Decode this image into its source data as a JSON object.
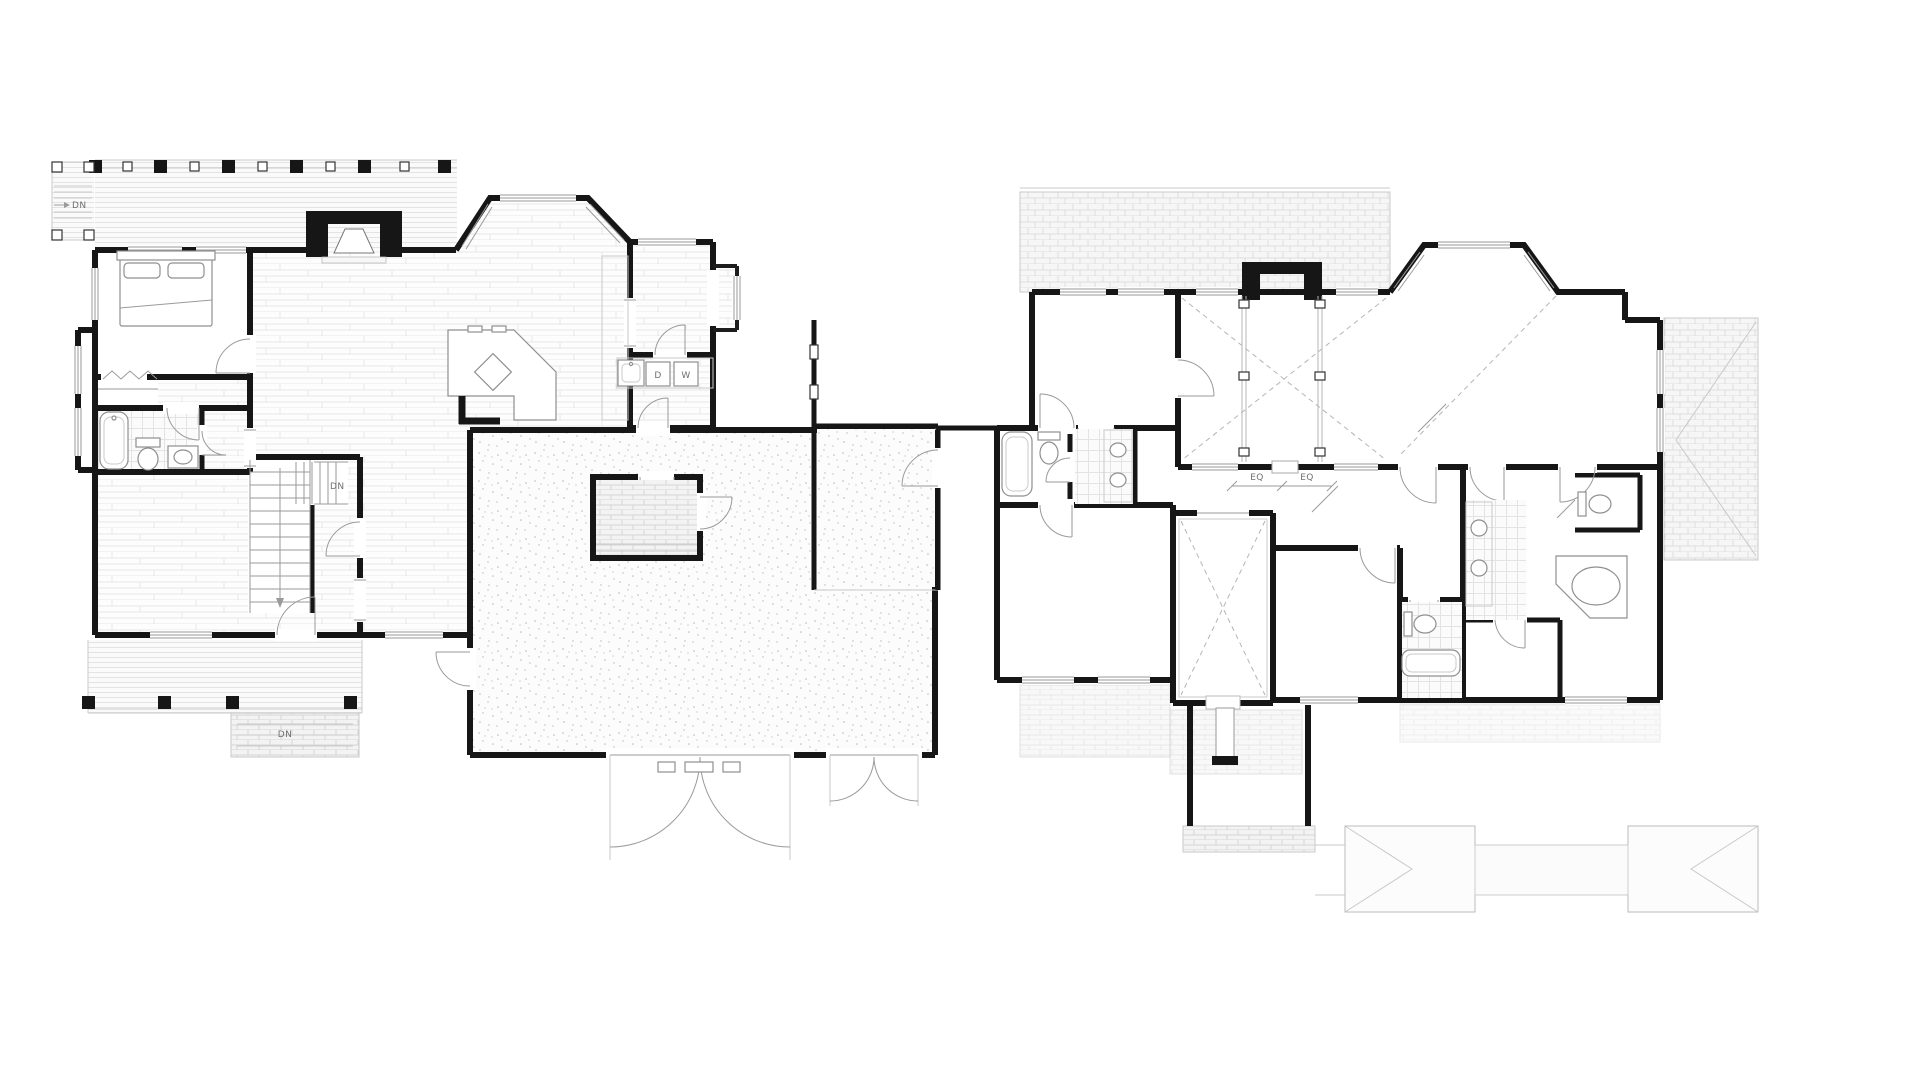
{
  "drawing": {
    "first_floor": {
      "labels": {
        "side_porch_down": "DN",
        "stairs_down": "DN",
        "front_steps_down": "DN",
        "dryer": "D",
        "washer": "W"
      }
    },
    "second_floor": {
      "labels": {
        "dim_eq_left": "EQ",
        "dim_eq_right": "EQ"
      }
    },
    "colors": {
      "walls": "#161616",
      "thin_lines": "#9a9a9a",
      "light_lines": "#c9c9c9",
      "dashed_lines": "#b5b5b5",
      "labels": "#6f6f6f",
      "paper": "#ffffff"
    }
  }
}
